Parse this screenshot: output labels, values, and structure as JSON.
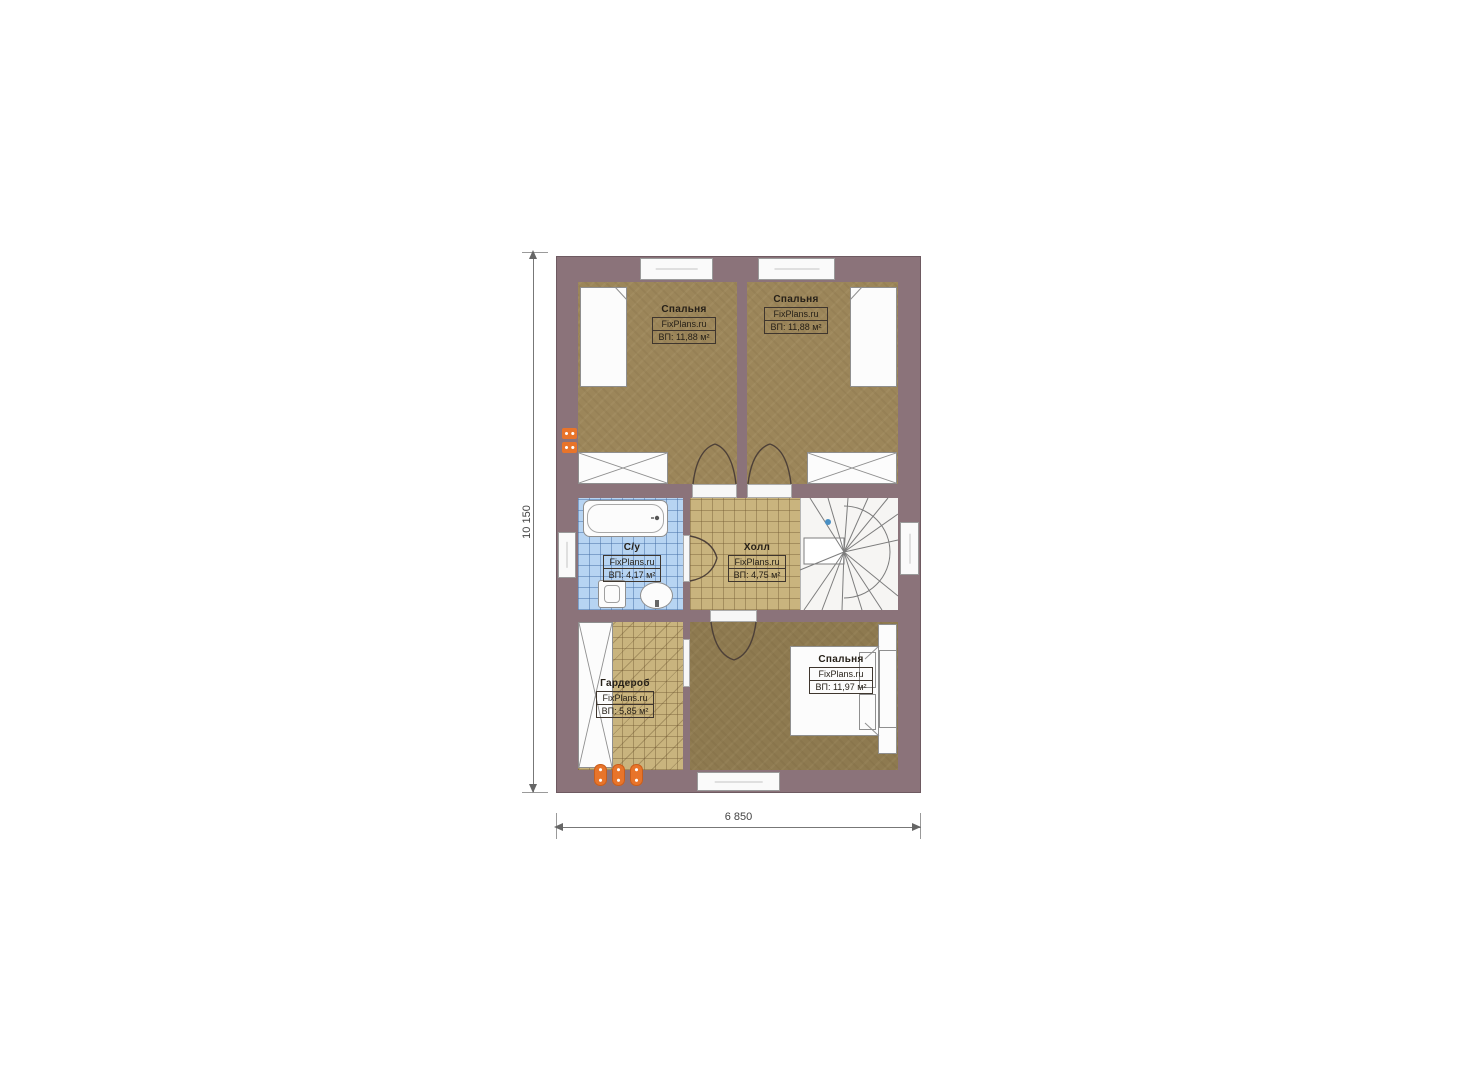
{
  "plan": {
    "brand": "FixPlans.ru",
    "rooms": [
      {
        "id": "bedroom-top-left",
        "name": "Спальня",
        "brand": "FixPlans.ru",
        "area": "ВП: 11,88 м²"
      },
      {
        "id": "bedroom-top-right",
        "name": "Спальня",
        "brand": "FixPlans.ru",
        "area": "ВП: 11,88 м²"
      },
      {
        "id": "bathroom",
        "name": "С/у",
        "brand": "FixPlans.ru",
        "area": "ВП: 4,17 м²"
      },
      {
        "id": "hall",
        "name": "Холл",
        "brand": "FixPlans.ru",
        "area": "ВП: 4,75 м²"
      },
      {
        "id": "wardrobe",
        "name": "Гардероб",
        "brand": "FixPlans.ru",
        "area": "ВП: 5,85 м²"
      },
      {
        "id": "bedroom-bottom",
        "name": "Спальня",
        "brand": "FixPlans.ru",
        "area": "ВП: 11,97 м²"
      }
    ],
    "dimensions": {
      "height_label": "10 150",
      "width_label": "6 850"
    },
    "colors": {
      "wall": "#8b737a",
      "bedroom_floor": "#9c865a",
      "bedroom_floor_dark": "#8e7a50",
      "tile_floor": "#c9b47e",
      "bathroom_floor": "#b7d4f2",
      "stairs": "#f6f5f3",
      "outlet": "#e8742a",
      "dimension": "#666666"
    }
  }
}
